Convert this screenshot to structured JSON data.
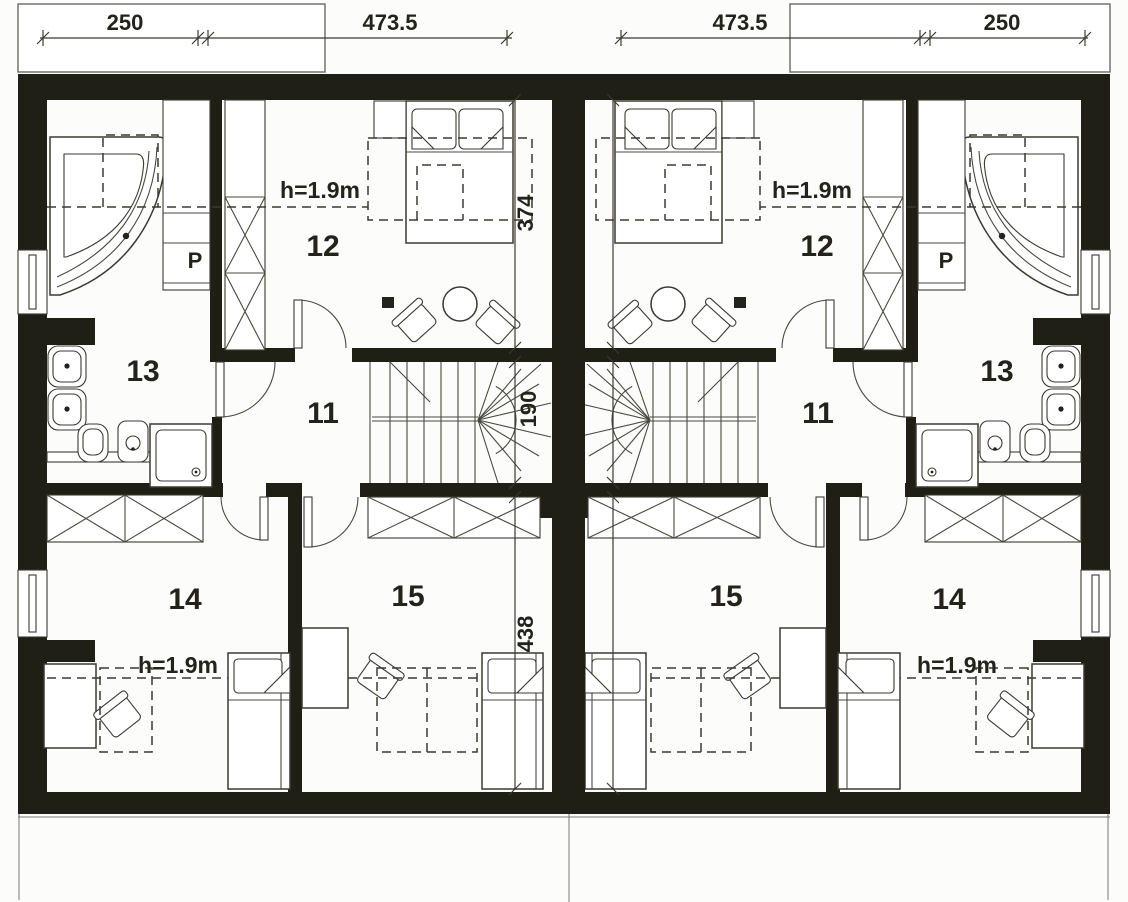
{
  "top_dimensions": {
    "left": [
      "250",
      "473.5"
    ],
    "right": [
      "473.5",
      "250"
    ]
  },
  "party_wall_dimensions": [
    "374",
    "190",
    "438"
  ],
  "labels": {
    "height_note": "h=1.9m",
    "closet": "P"
  },
  "rooms": {
    "hall": "11",
    "bedroom": "12",
    "bathroom": "13",
    "room14": "14",
    "room15": "15"
  },
  "colors": {
    "wall": "#201f15",
    "line": "#3b3a30",
    "background": "#fcfcfb"
  }
}
